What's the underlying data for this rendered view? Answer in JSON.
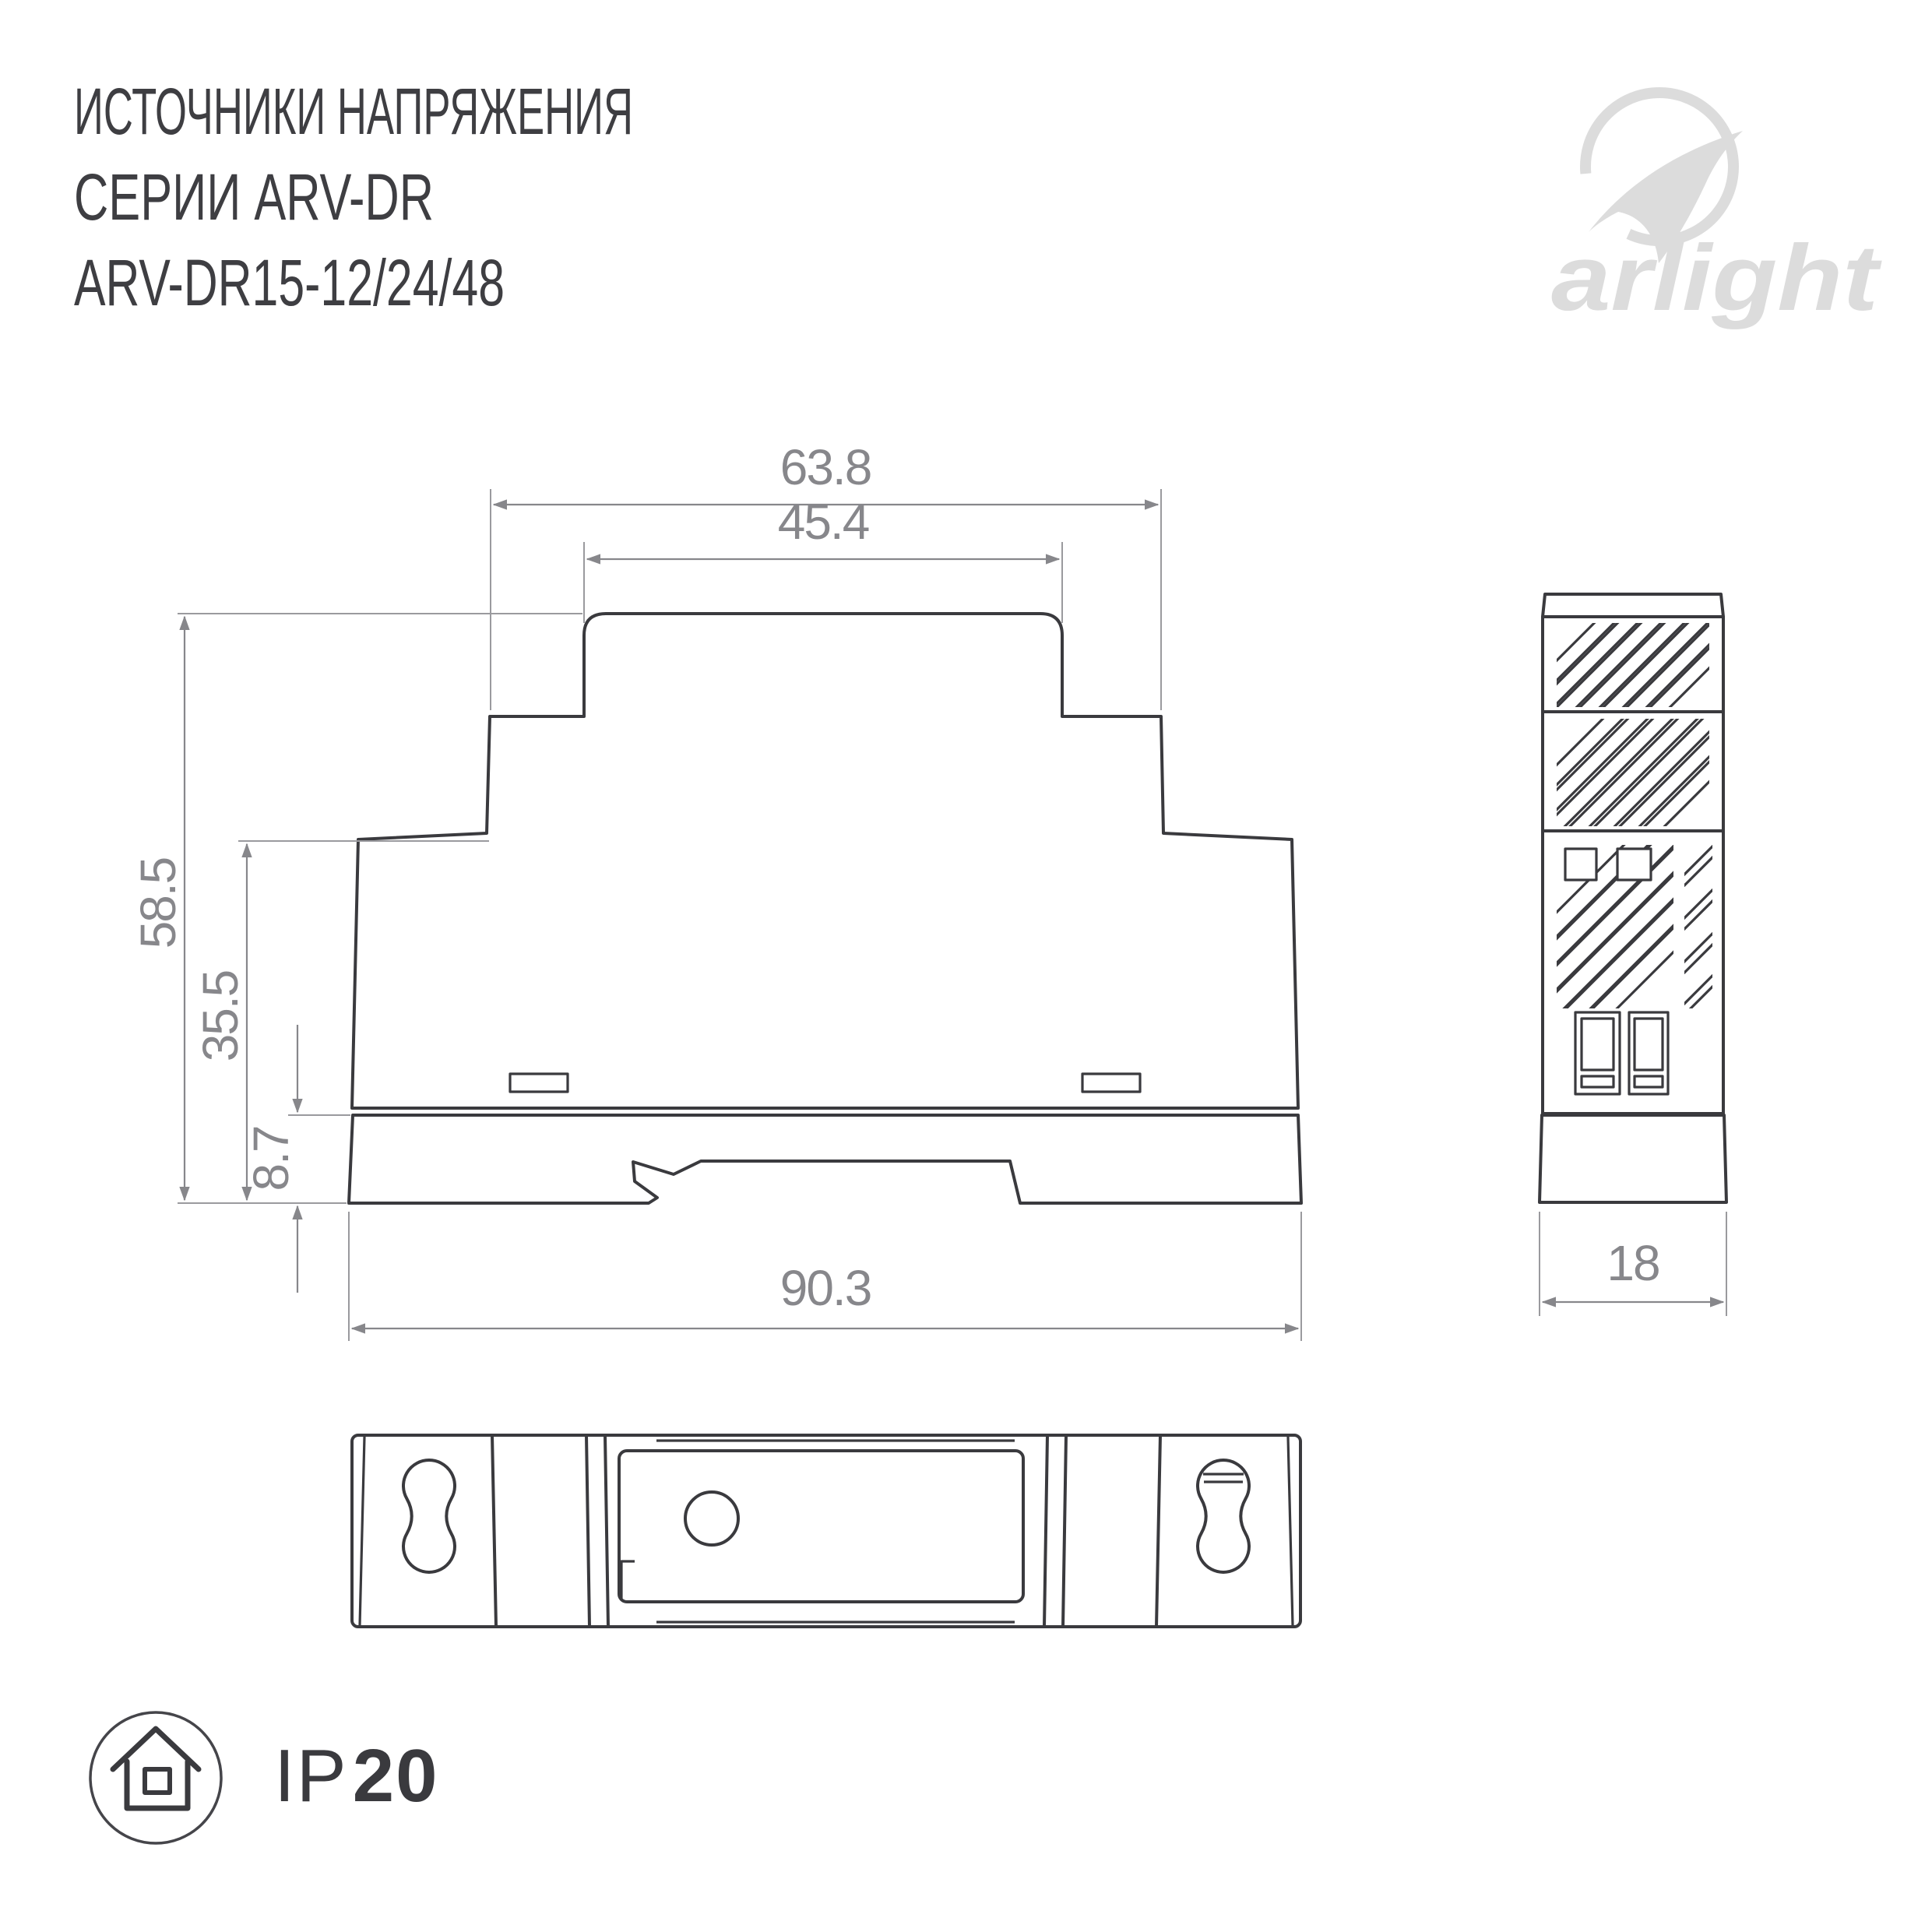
{
  "title": {
    "line1": "ИСТОЧНИКИ НАПРЯЖЕНИЯ",
    "line2": "СЕРИИ ARV-DR",
    "line3": "ARV-DR15-12/24/48"
  },
  "logo": {
    "wordmark": "arlight"
  },
  "dimensions": {
    "top_width": "63.8",
    "cap_width": "45.4",
    "total_height": "58.5",
    "body_height": "35.5",
    "foot_height": "8.7",
    "base_width": "90.3",
    "depth": "18"
  },
  "ip_rating": {
    "prefix": "IP",
    "value": "20"
  },
  "colors": {
    "outline": "#3a3a3e",
    "dimension_gray": "#87878b",
    "logo_gray": "#dcdcdc",
    "title_gray": "#3e3e42",
    "background": "#ffffff"
  }
}
